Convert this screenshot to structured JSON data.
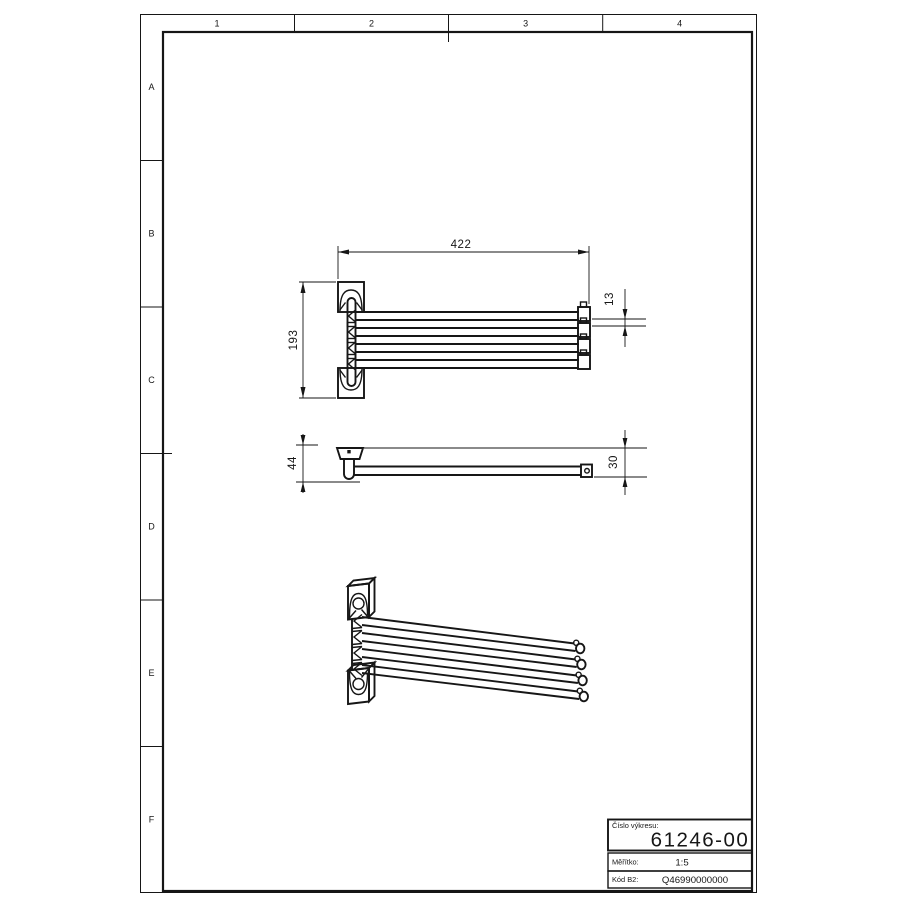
{
  "sheet": {
    "zone_columns": [
      "1",
      "2",
      "3",
      "4"
    ],
    "zone_rows": [
      "A",
      "B",
      "C",
      "D",
      "E",
      "F"
    ]
  },
  "drawing": {
    "dim_width": "422",
    "dim_height": "193",
    "dim_arm": "13",
    "dim_depth": "44",
    "dim_bar": "30"
  },
  "title_block": {
    "drawing_number_label": "Číslo výkresu:",
    "drawing_number": "61246-00",
    "scale_label": "Měřítko:",
    "scale_value": "1:5",
    "code_label": "Kód B2:",
    "code_value": "Q46990000000"
  },
  "colors": {
    "line": "#161616",
    "background": "#ffffff"
  }
}
